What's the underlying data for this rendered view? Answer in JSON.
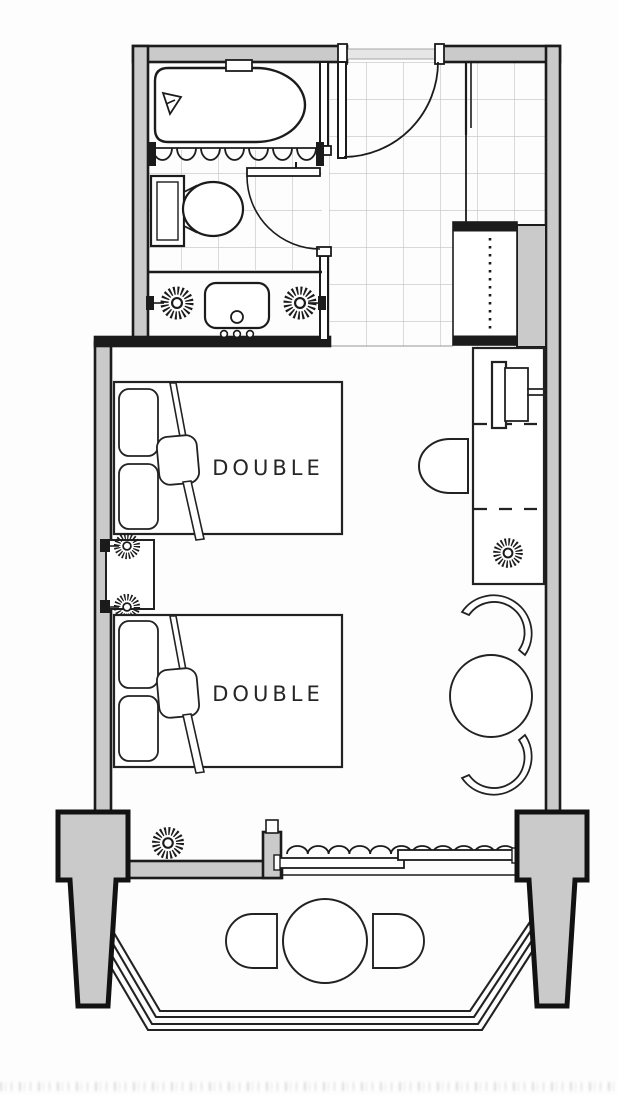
{
  "plan": {
    "type": "hotel-guestroom-floor-plan",
    "labels": {
      "bed1": "DOUBLE",
      "bed2": "DOUBLE"
    },
    "colors": {
      "wall_fill": "#cacaca",
      "line": "#1b1b1b",
      "tile_line": "#c3c3c3",
      "background": "#fdfdfd"
    },
    "icons": {
      "bathtub": "bathtub-icon",
      "shower_curtain": "scalloped-curtain-icon",
      "toilet": "toilet-icon",
      "vanity_sink": "vanity-sink-icon",
      "wall_lamp": "sunburst-lamp-icon",
      "entry_door": "door-swing-icon",
      "bathroom_door": "door-swing-icon",
      "wardrobe": "wardrobe-dashed-rail-icon",
      "tv": "tv-on-console-icon",
      "desk_chair": "d-shape-chair-icon",
      "lounge_chair": "curved-tub-chair-icon",
      "round_table": "round-table-icon",
      "balcony_curtain": "wavy-curtain-icon",
      "sliding_door": "sliding-door-panels-icon",
      "balcony_railing": "multi-rail-railing-icon",
      "column": "tapered-pier-icon"
    }
  }
}
